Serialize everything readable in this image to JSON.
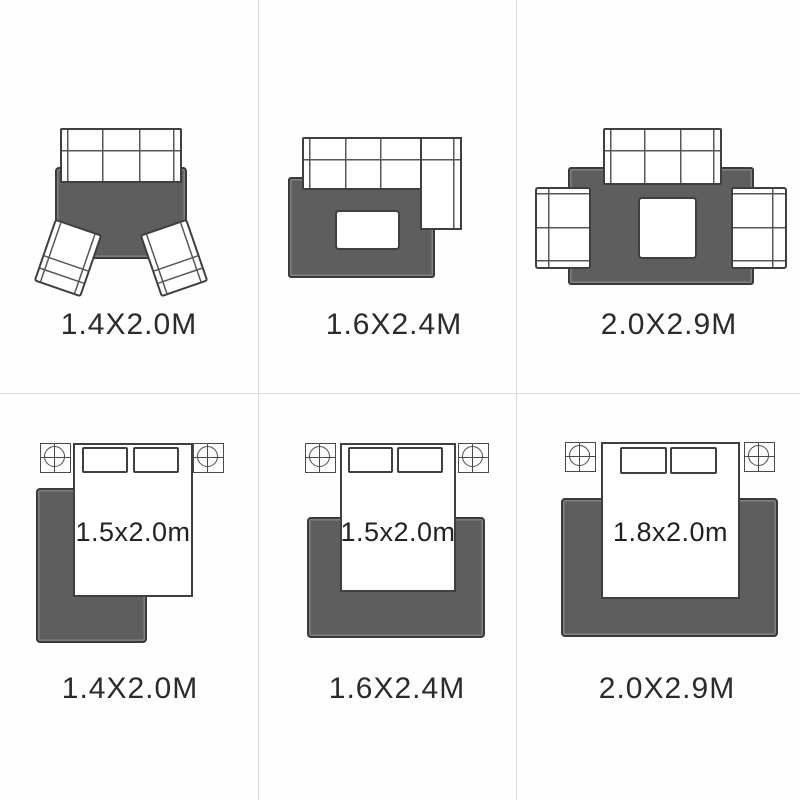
{
  "panels": {
    "living_room": [
      {
        "caption": "1.4X2.0M"
      },
      {
        "caption": "1.6X2.4M"
      },
      {
        "caption": "2.0X2.9M"
      }
    ],
    "bedroom": [
      {
        "bed_size_label": "1.5x2.0m",
        "caption": "1.4X2.0M"
      },
      {
        "bed_size_label": "1.5x2.0m",
        "caption": "1.6X2.4M"
      },
      {
        "bed_size_label": "1.8x2.0m",
        "caption": "2.0X2.9M"
      }
    ]
  },
  "icons": {
    "nightstand_lamp": "circle-crosshair"
  },
  "colors": {
    "rug": "#5e5e5e",
    "rug_border": "#3a3a3a",
    "furniture_outline": "#3f3f3f",
    "text": "#2b2b2b",
    "grid_line": "#dadada",
    "background": "#fefefe"
  }
}
